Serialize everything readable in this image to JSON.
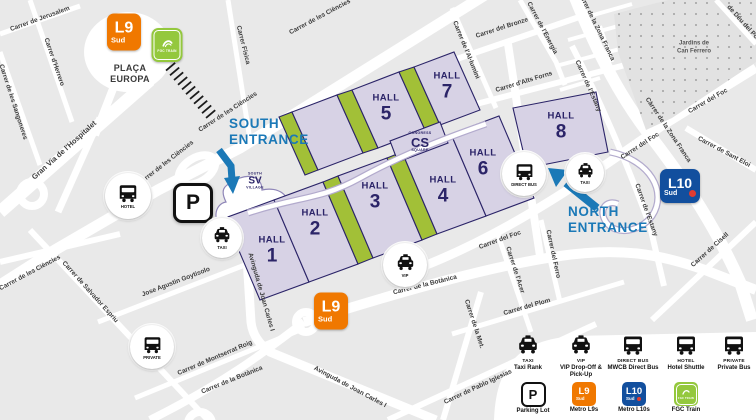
{
  "entrances": {
    "south": {
      "line1": "SOUTH",
      "line2": "ENTRANCE"
    },
    "north": {
      "line1": "NORTH",
      "line2": "ENTRANCE"
    }
  },
  "halls": [
    {
      "label": "HALL",
      "num": "1"
    },
    {
      "label": "HALL",
      "num": "2"
    },
    {
      "label": "HALL",
      "num": "3"
    },
    {
      "label": "HALL",
      "num": "4"
    },
    {
      "label": "HALL",
      "num": "5"
    },
    {
      "label": "HALL",
      "num": "6"
    },
    {
      "label": "HALL",
      "num": "7"
    },
    {
      "label": "HALL",
      "num": "8"
    }
  ],
  "villages": {
    "cs": {
      "top": "CONGRESS",
      "main": "CS",
      "bottom": "SQUARE"
    },
    "sv": {
      "top": "SOUTH",
      "main": "SV",
      "bottom": "VILLAGE"
    }
  },
  "metro": {
    "l9": {
      "name": "L9",
      "sub": "Sud"
    },
    "l10": {
      "name": "L10",
      "sub": "Sud"
    },
    "fgc": {
      "label": "FGC TRAIN"
    }
  },
  "poi": {
    "hotel": {
      "label": "HOTEL"
    },
    "parking": {
      "label": "P"
    },
    "taxi_south": {
      "label": "TAXI"
    },
    "private": {
      "label": "PRIVATE"
    },
    "vip": {
      "label": "VIP"
    },
    "direct_bus": {
      "label": "DIRECT BUS"
    },
    "taxi_north": {
      "label": "TAXI"
    }
  },
  "places": {
    "placa_europa": {
      "line1": "PLAÇA",
      "line2": "EUROPA"
    },
    "park": {
      "line1": "Jardins de",
      "line2": "Can Ferrero"
    }
  },
  "streets": [
    "Carrer de Jerusalem",
    "Carrer d'Herrero",
    "Carrer de les Sangoneres",
    "Gran Via de l'Hospitalet",
    "Carrer Física",
    "Carrer de les Ciències",
    "Carrer de Salvador Espriu",
    "Jose Agustin Goytisolo",
    "Carrer de Montserrat Roig",
    "Avinguda de Joan Carles I",
    "Carrer de la Botànica",
    "Carrer de Pablo Iglesias",
    "Carrer de la Met.",
    "Carrer del Plom",
    "Carrer de l'Acer",
    "Carrer del Ferro",
    "Carrer del Foc",
    "Carrer de la Zona Franca",
    "Carrer de l'Estany",
    "Carrer de Sant Eloi",
    "Carrer de Cisell",
    "Carrer del Bronze",
    "Carrer de l'Al·lumini",
    "Carrer d'Alts Forns",
    "Carrer de l'Energia",
    "de Déu del Port"
  ],
  "legend": {
    "row1": [
      {
        "icon": "taxi-car",
        "title": "TAXI",
        "desc": "Taxi Rank"
      },
      {
        "icon": "vip-car",
        "title": "VIP",
        "desc": "VIP Drop-Off & Pick-Up"
      },
      {
        "icon": "direct-bus",
        "title": "DIRECT BUS",
        "desc": "MWCB Direct Bus"
      },
      {
        "icon": "hotel-bus",
        "title": "HOTEL",
        "desc": "Hotel Shuttle"
      },
      {
        "icon": "private-bus",
        "title": "PRIVATE",
        "desc": "Private Bus"
      }
    ],
    "row2": [
      {
        "icon": "parking",
        "desc": "Parking Lot"
      },
      {
        "icon": "metro-l9",
        "desc": "Metro L9s"
      },
      {
        "icon": "metro-l10",
        "desc": "Metro L10s"
      },
      {
        "icon": "fgc",
        "desc": "FGC Train"
      }
    ]
  },
  "colors": {
    "accent_blue": "#1b79b7",
    "metro_l9_orange": "#f07800",
    "metro_l10_blue": "#124f9e",
    "fgc_green": "#94c83d",
    "hall_fill": "#d7d2e5",
    "hall_outline": "#2b2468",
    "green_strip": "#a2c037"
  }
}
